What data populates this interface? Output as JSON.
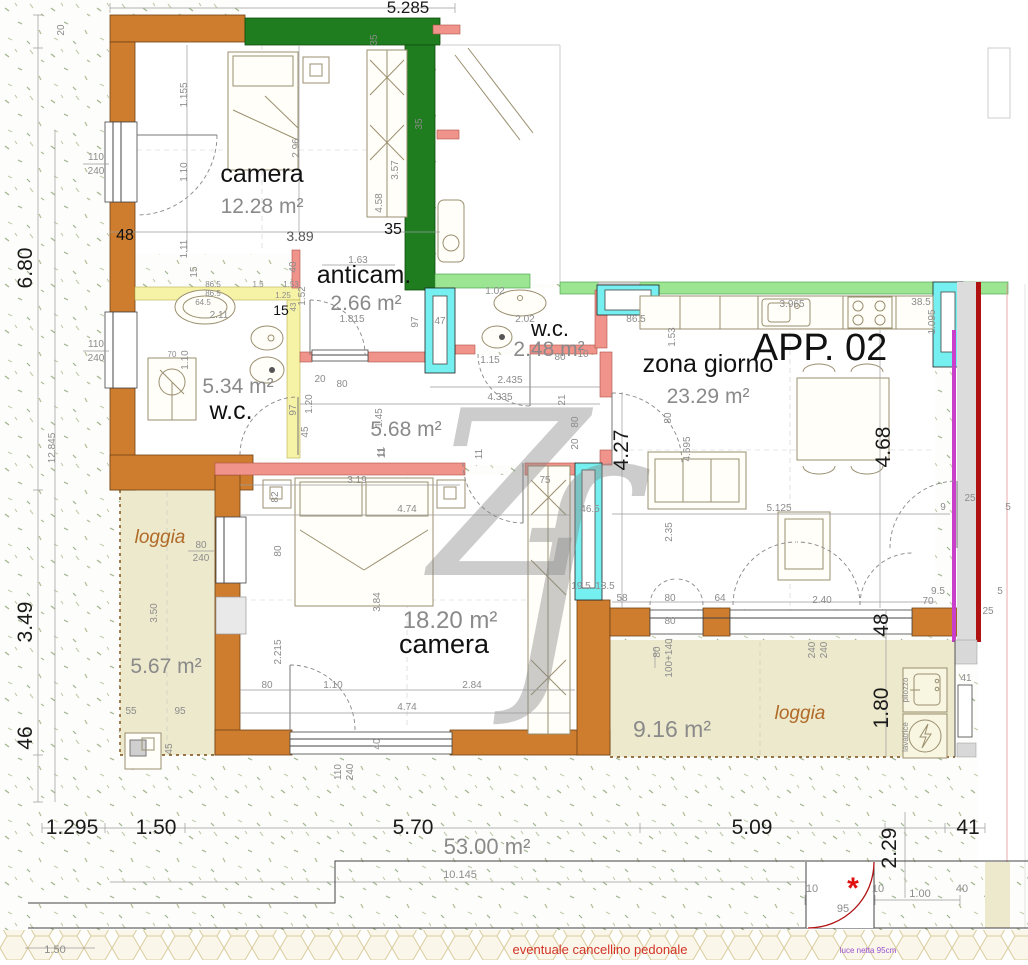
{
  "title": "APP. 02",
  "total_area": "53.00 m²",
  "watermark": {
    "part1": "Z",
    "part2": "ſ"
  },
  "rooms": [
    {
      "name": "camera",
      "area": "12.28 m²"
    },
    {
      "name": "anticam.",
      "area": "2.66 m²"
    },
    {
      "name": "w.c.",
      "area": "5.34 m²"
    },
    {
      "name": "w.c.",
      "area": "2.48 m²"
    },
    {
      "name": "zona giorno",
      "area": "23.29 m²"
    },
    {
      "name": "camera",
      "area": "18.20 m²"
    },
    {
      "name": "loggia",
      "area": "5.67 m²"
    },
    {
      "name": "loggia",
      "area": "9.16 m²"
    },
    {
      "name": "disimpegno",
      "area": "5.68 m²"
    }
  ],
  "annotations": {
    "gate_note": "eventuale cancellino pedonale",
    "clearance_note": "luce netta 95cm",
    "asterisk": "*",
    "pilozzo": "pilozzo",
    "lavatrice": "lavatrice"
  },
  "colors": {
    "wall_exterior": "#ce7d2f",
    "wall_party_dark_green": "#1f7d1f",
    "wall_party_light_green": "#9be593",
    "wall_interior_salmon": "#f0938b",
    "wall_bath_yellow": "#f6f2a6",
    "window_cyan": "#75efef",
    "loggia_floor": "#ede9cc",
    "accent_magenta": "#c93ecb",
    "accent_dark_red": "#b01212",
    "note_red": "#d23227",
    "note_purple": "#9a4fd0"
  },
  "dims": {
    "top": "5.285",
    "l20": "20",
    "l680": "6.80",
    "l12845": "12.845",
    "l349": "3.49",
    "l46": "46",
    "b1295": "1.295",
    "b150": "1.50",
    "b570": "5.70",
    "b509": "5.09",
    "b229": "2.29",
    "b41": "41",
    "b10145": "10.145",
    "b150b": "1.50",
    "g10a": "10",
    "g95": "95",
    "g10b": "10",
    "g100": "1.00",
    "g40": "40",
    "w1a": "110",
    "w1b": "240",
    "w2a": "110",
    "w2b": "240",
    "w3a": "80",
    "w3b": "240",
    "w4a": "110",
    "w4b": "240",
    "w5a": "80",
    "w5b": "100+140",
    "w6a": "240",
    "w6b": "240",
    "c1_48": "48",
    "c1_389": "3.89",
    "c1_35": "35",
    "c1_296": "2.96",
    "c1_1155": "1.155",
    "c1_110": "1.10",
    "c1_111": "1.11",
    "c1_15": "15",
    "c1_458": "4.58",
    "c1_357": "3.57",
    "gw35a": "35",
    "gw35b": "35",
    "a163": "1.63",
    "a152": "1.52",
    "a1815": "1.815",
    "a97": "97",
    "a40": "40",
    "wc1_865a": "86.5",
    "wc1_865b": "86.5",
    "wc1_15": "1.5",
    "wc1_153": "1.53",
    "wc1_125": "1.25",
    "wc1_43": "43",
    "wc1_645": "64.5",
    "wc1_211": "2.11",
    "wc1_15b": "15",
    "wc1_110": "1.10",
    "wc1_70": "70",
    "wc1_97": "97",
    "wc1_120": "1.20",
    "wc2_47": "47",
    "wc2_102": "1.02",
    "wc2_202": "2.02",
    "wc2_115": "1.15",
    "wc2_80": "80",
    "wc2_10": "10",
    "wc2_865": "86.5",
    "co2435": "2.435",
    "co4335": "4.335",
    "co45": "45",
    "co20": "20",
    "co80": "80",
    "co145": "1.45",
    "co80b": "80",
    "co20b": "20",
    "co21": "21",
    "co11": "11",
    "zg153": "1.53",
    "zg3965": "3.965",
    "zg385": "38.5",
    "zg1095": "1.095",
    "zg80": "80",
    "zg4695": "4.695",
    "zg427": "4.27",
    "zg468": "4.68",
    "zg5125": "5.125",
    "zg235": "2.35",
    "zg25a": "25",
    "zg9": "9",
    "zg5a": "5",
    "zg95": "9.5",
    "zg5b": "5",
    "zg25b": "25",
    "zg70": "70",
    "c2_319": "3.19",
    "c2_474": "4.74",
    "c2_384": "3.84",
    "c2_2215": "2.215",
    "c2_80": "80",
    "c2_80b": "80",
    "c2_110": "1.10",
    "c2_284": "2.84",
    "c2_474b": "4.74",
    "c2_75": "75",
    "c2_465": "46.5",
    "c2_195": "19.5",
    "c2_135": "13.5",
    "c2_82": "82",
    "c2_11a": "11",
    "c2_11b": "11",
    "c2_40": "40",
    "lb58": "58",
    "lb80": "80",
    "lb64": "64",
    "lb240": "2.40",
    "lb80b": "80",
    "lb48": "48",
    "lb180": "1.80",
    "lb41": "41",
    "lg350": "3.50",
    "lg55": "55",
    "lg95": "95",
    "lg45": "45"
  }
}
